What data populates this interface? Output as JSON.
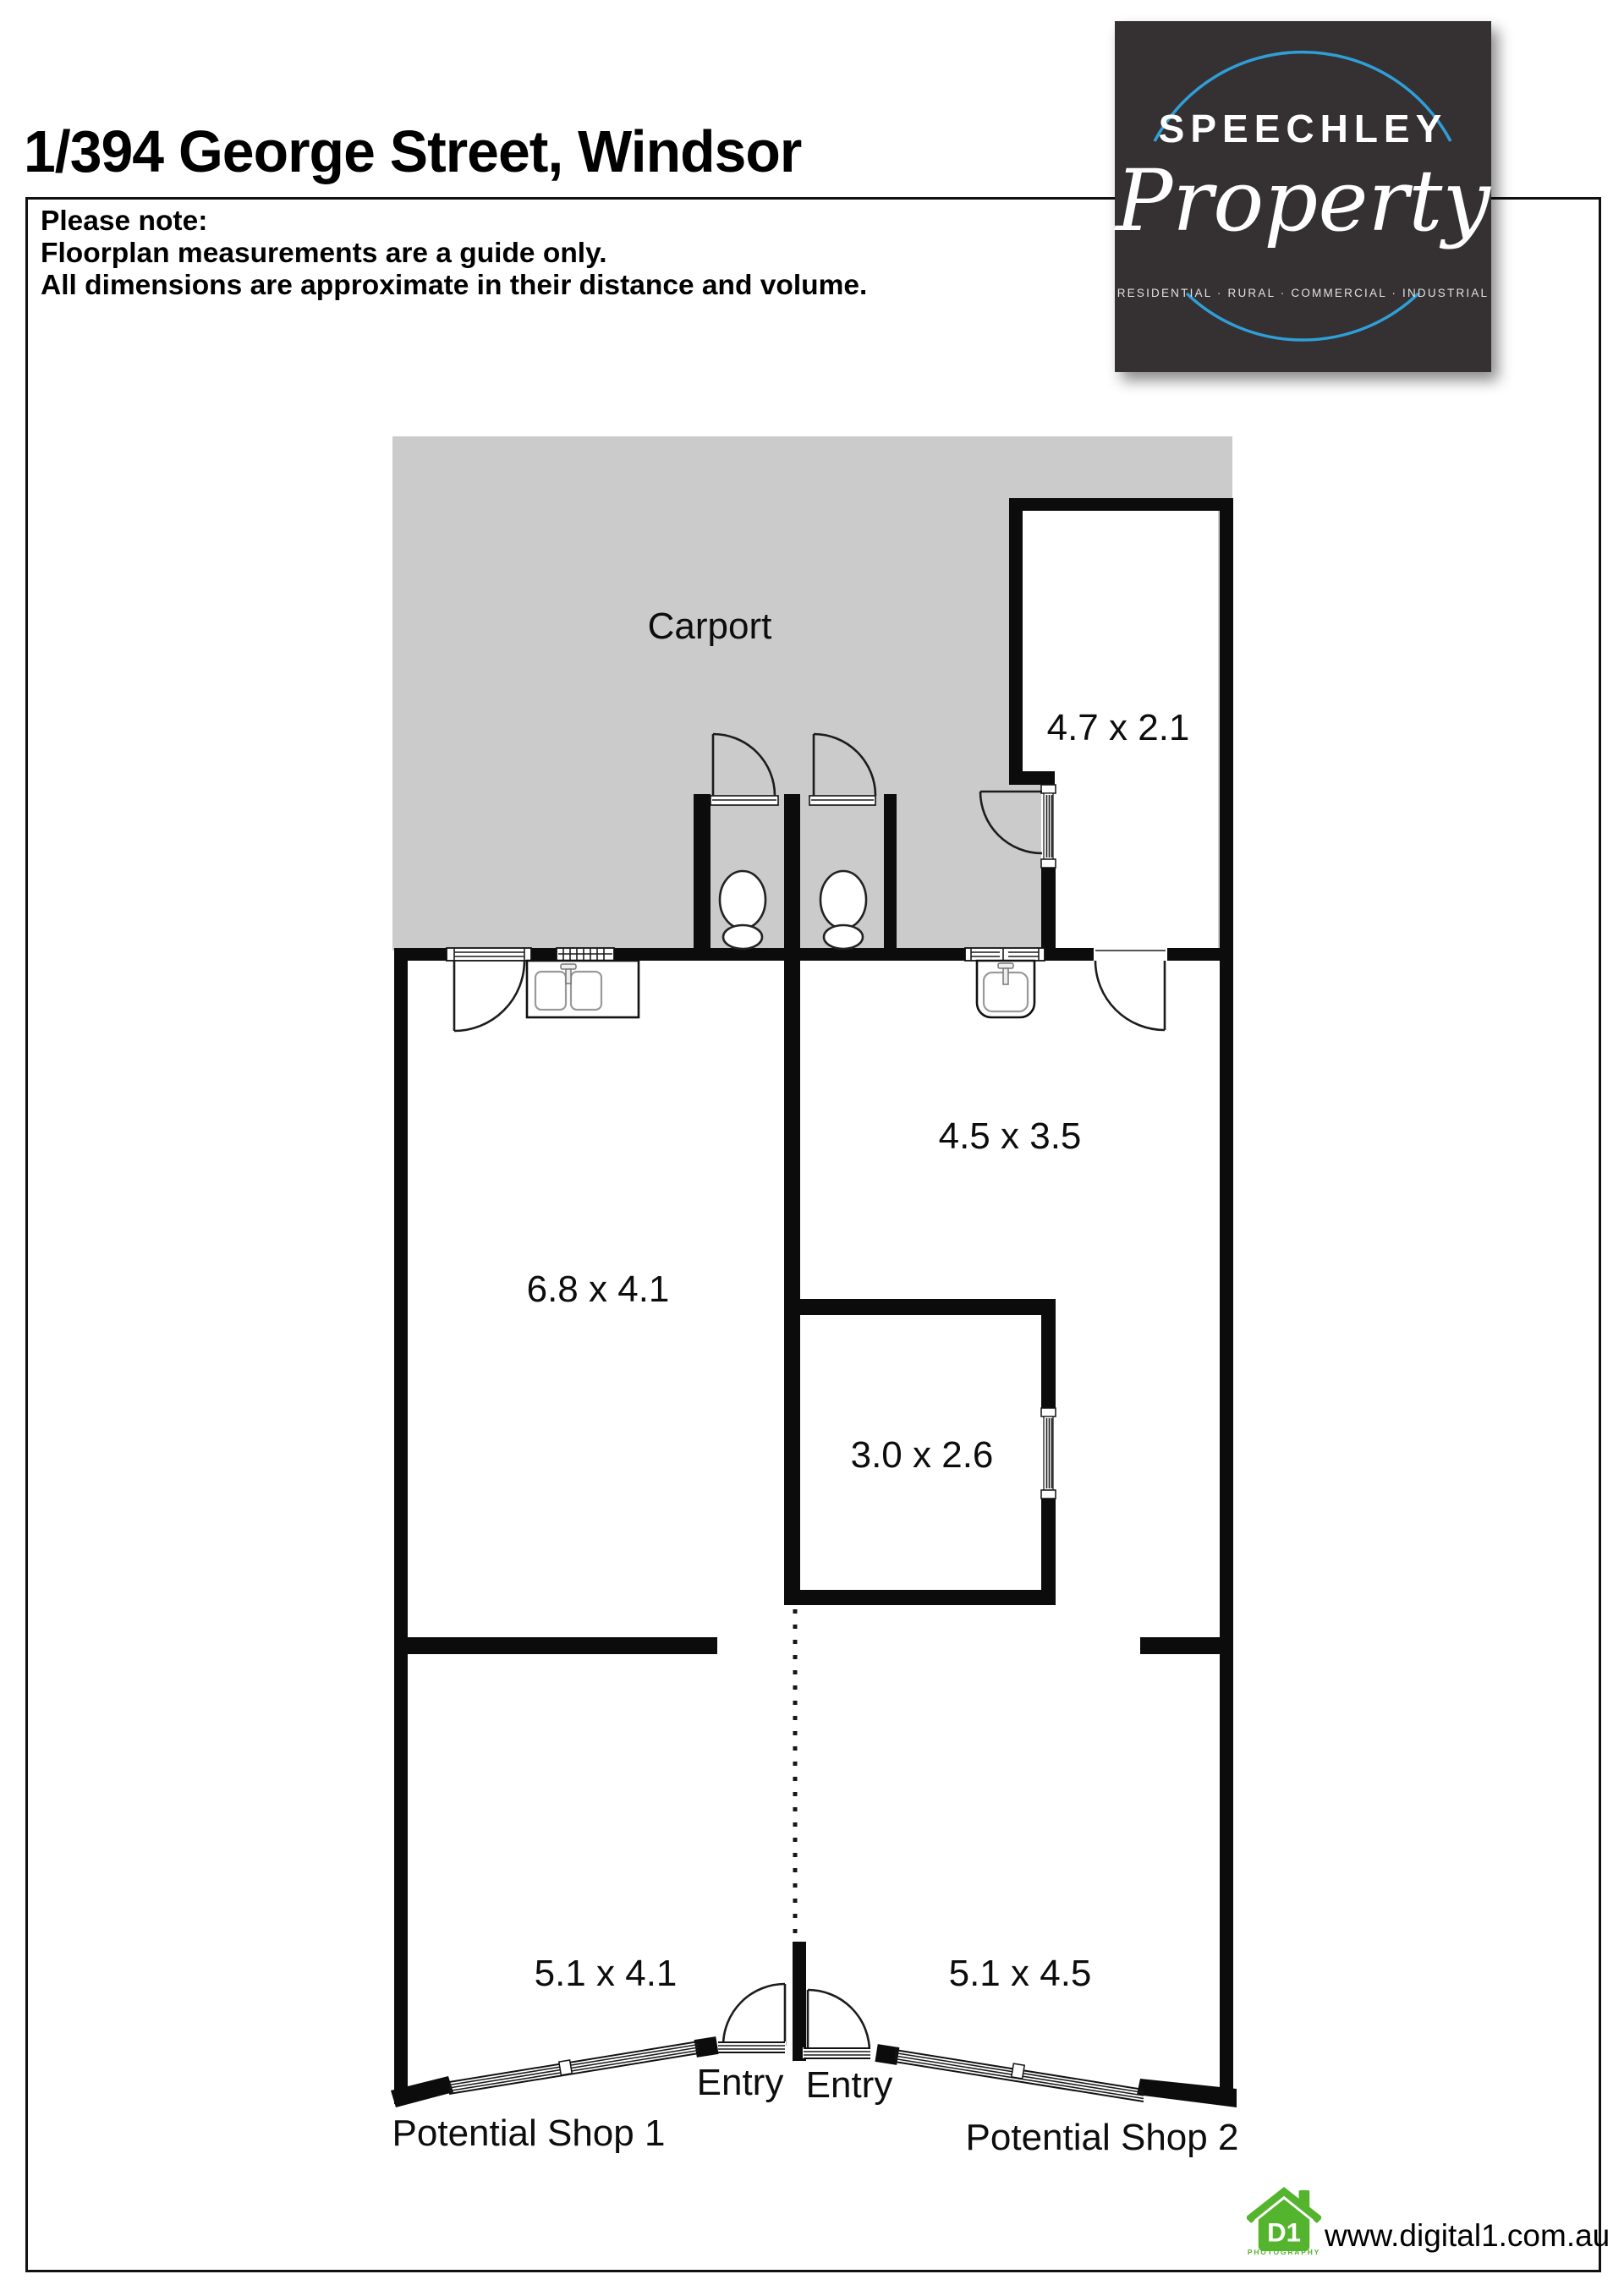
{
  "title": "1/394 George Street, Windsor",
  "note": {
    "line1": "Please note:",
    "line2": "Floorplan measurements are a guide only.",
    "line3": "All dimensions are approximate in their distance and volume."
  },
  "brand": {
    "name": "SPEECHLEY",
    "script": "Property",
    "tagline": "RESIDENTIAL · RURAL · COMMERCIAL · INDUSTRIAL"
  },
  "floorplan": {
    "labels": {
      "carport": "Carport",
      "store_4721": "4.7 x 2.1",
      "room_4535": "4.5 x 3.5",
      "room_6841": "6.8 x 4.1",
      "room_3026": "3.0 x 2.6",
      "shop1_size": "5.1 x 4.1",
      "shop2_size": "5.1 x 4.5",
      "entry_left": "Entry",
      "entry_right": "Entry",
      "shop1": "Potential Shop 1",
      "shop2": "Potential Shop 2"
    }
  },
  "footer": {
    "website": "www.digital1.com.au",
    "logo_main": "D1",
    "logo_sub": "PHOTOGRAPHY"
  },
  "colors": {
    "carport_fill": "#cbcbcb",
    "wall": "#0c0c0c",
    "brand_bg": "#353132",
    "brand_blue": "#2f9fd8",
    "digital1_green": "#54b42d"
  }
}
